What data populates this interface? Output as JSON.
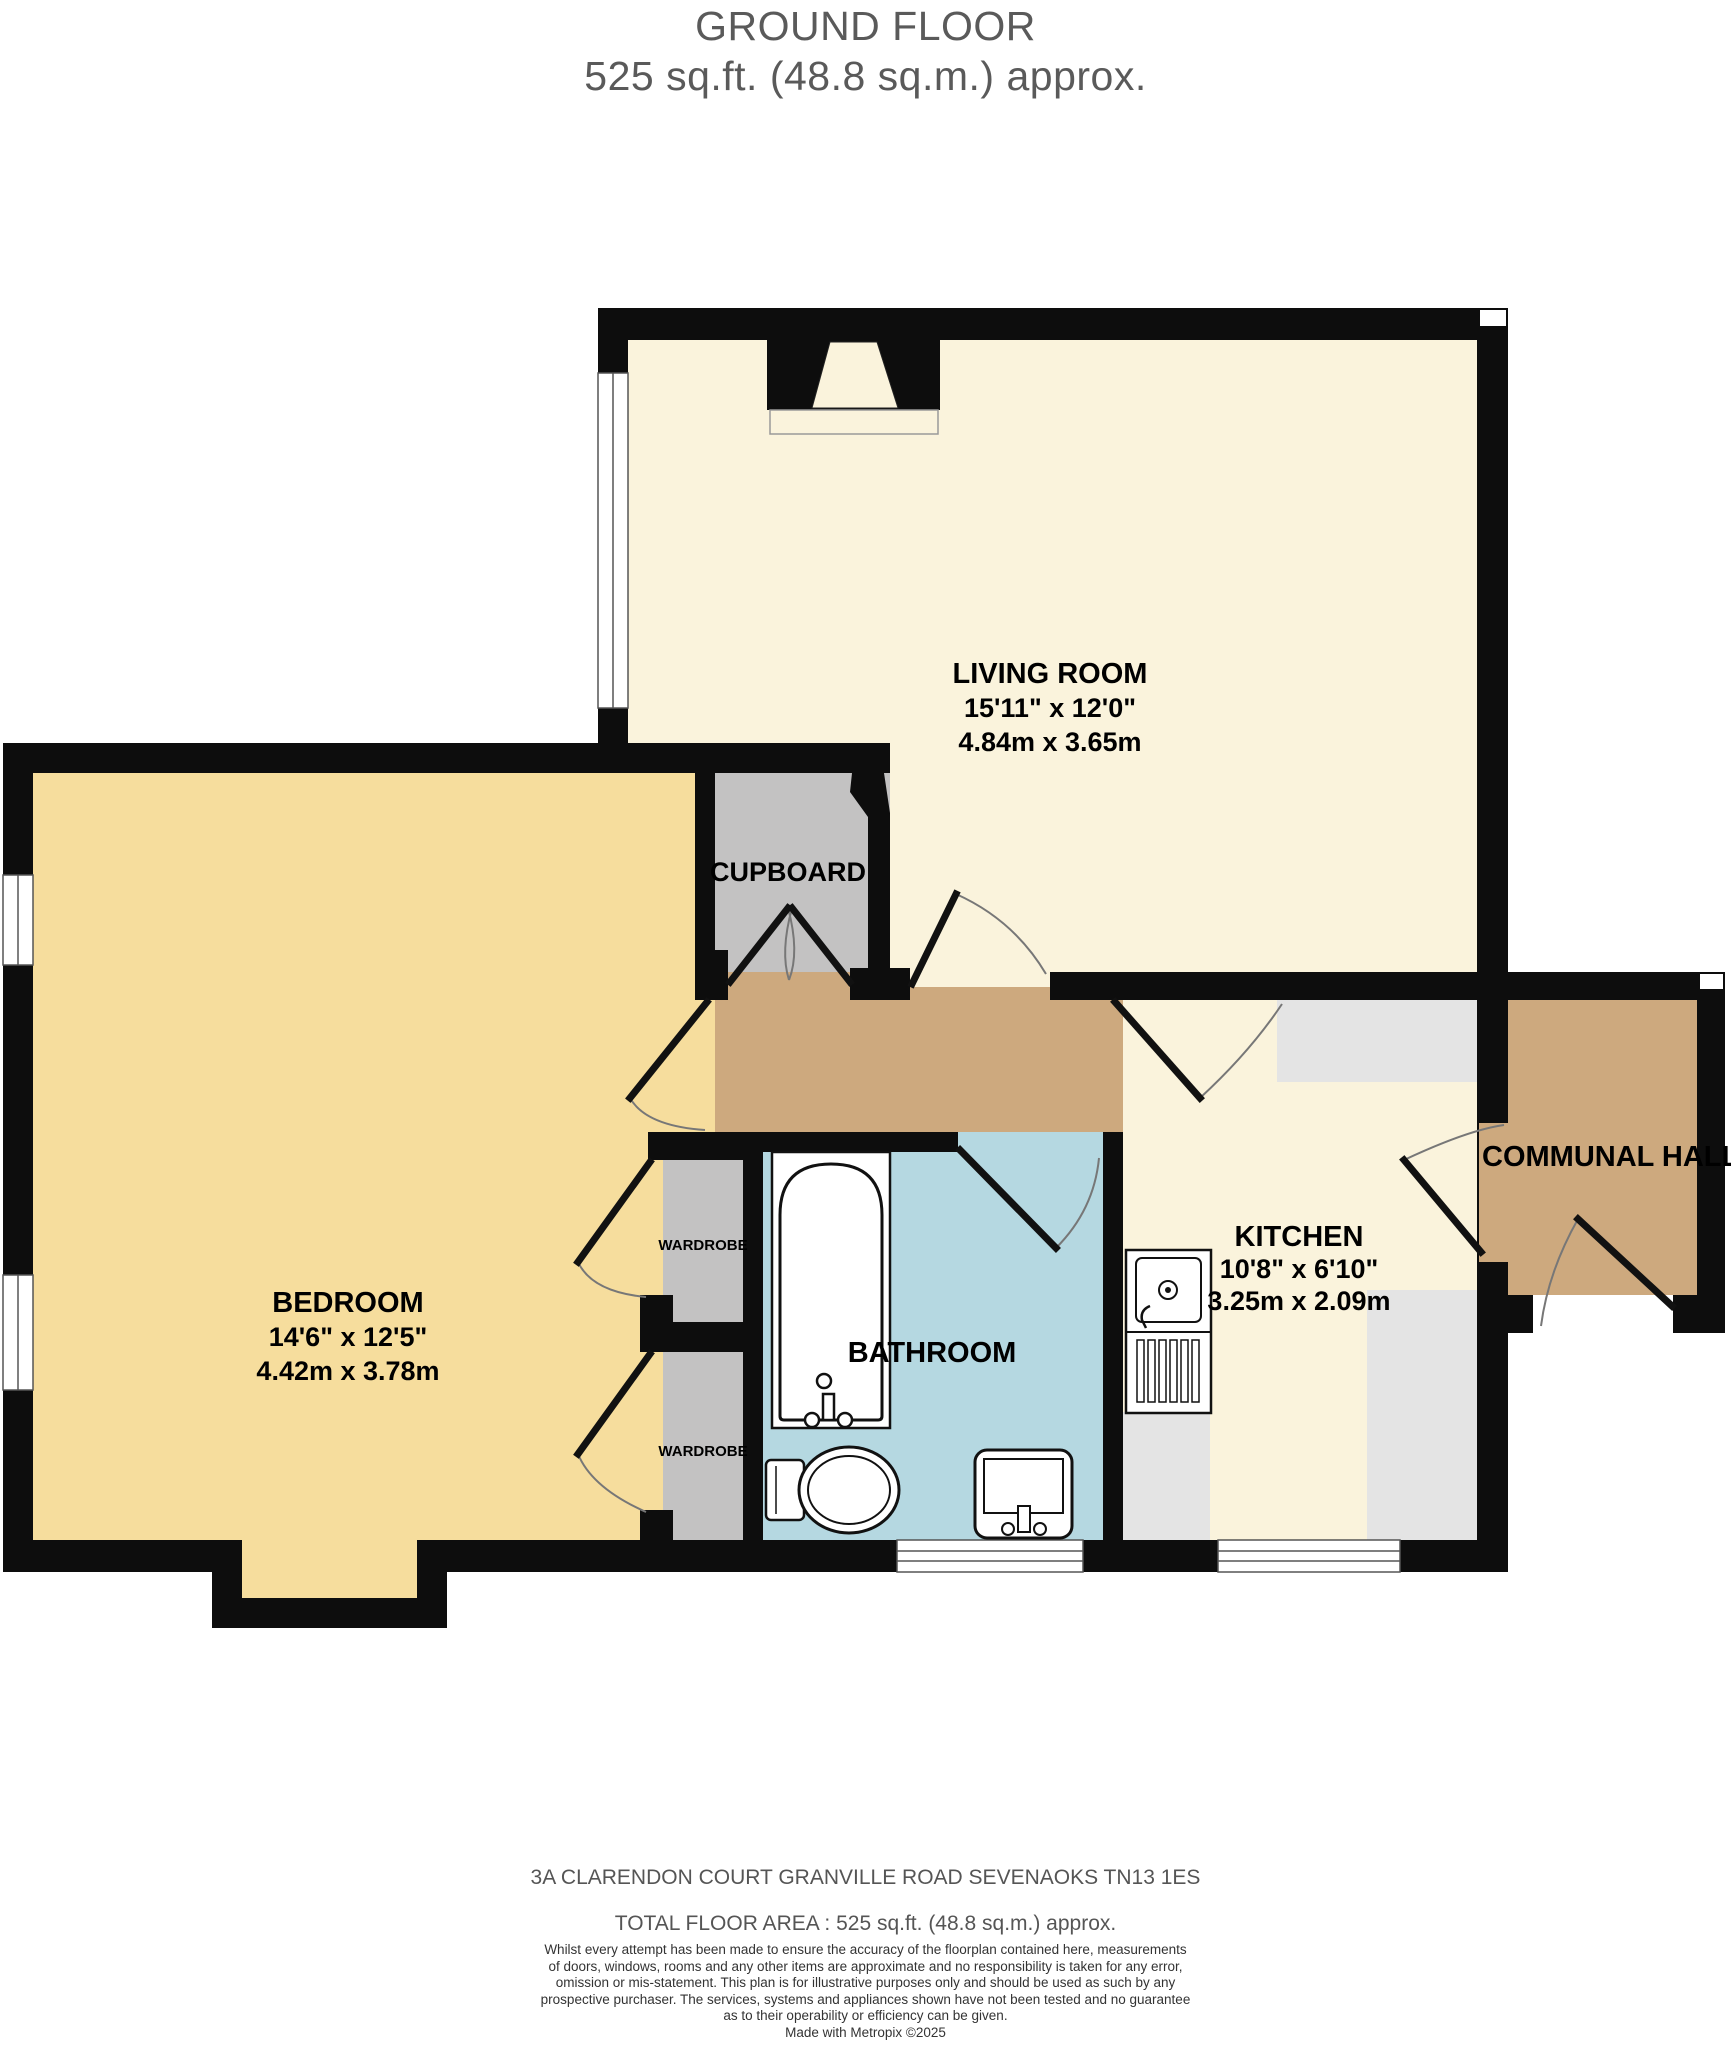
{
  "title": {
    "line1": "GROUND FLOOR",
    "line2": "525 sq.ft. (48.8 sq.m.) approx."
  },
  "rooms": {
    "living_room": {
      "name": "LIVING ROOM",
      "imperial": "15'11\" x 12'0\"",
      "metric": "4.84m x 3.65m"
    },
    "bedroom": {
      "name": "BEDROOM",
      "imperial": "14'6\" x 12'5\"",
      "metric": "4.42m x 3.78m"
    },
    "kitchen": {
      "name": "KITCHEN",
      "imperial": "10'8\" x 6'10\"",
      "metric": "3.25m x 2.09m"
    },
    "bathroom": {
      "name": "BATHROOM"
    },
    "cupboard": {
      "name": "CUPBOARD"
    },
    "communal_hall": {
      "name": "COMMUNAL HALL"
    },
    "wardrobe": {
      "name": "WARDROBE"
    }
  },
  "footer": {
    "address": "3A CLARENDON COURT GRANVILLE ROAD SEVENAOKS TN13 1ES",
    "total_area": "TOTAL FLOOR AREA : 525 sq.ft. (48.8 sq.m.) approx.",
    "disclaimer_lines": [
      "Whilst every attempt has been made to ensure the accuracy of the floorplan contained here, measurements",
      "of doors, windows, rooms and any other items are approximate and no responsibility is taken for any error,",
      "omission or mis-statement. This plan is for illustrative purposes only and should be used as such by any",
      "prospective purchaser. The services, systems and appliances shown have not been tested and no guarantee",
      "as to their operability or efficiency can be given."
    ],
    "credit": "Made with Metropix ©2025"
  },
  "colors": {
    "wall": "#0d0d0d",
    "living": "#faf3dc",
    "bedroom": "#f6dd9d",
    "hall": "#cda97e",
    "bath": "#b5d8e1",
    "storage": "#c3c2c2",
    "counter": "#e4e4e4",
    "titletext": "#5a5a5a",
    "arc": "#777777"
  }
}
